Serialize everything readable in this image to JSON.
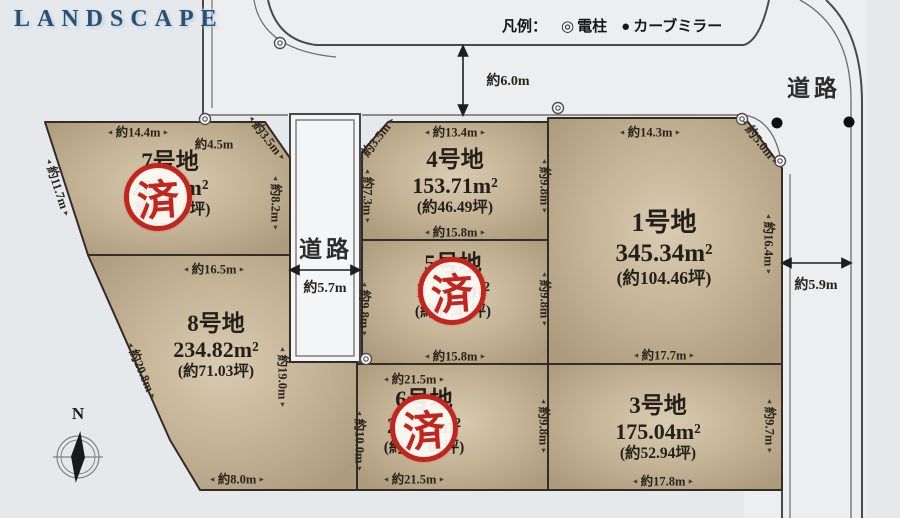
{
  "logo": "LANDSCAPE",
  "legend": {
    "label": "凡例：",
    "items": [
      {
        "symbol": "◎",
        "name": "電柱"
      },
      {
        "symbol": "●",
        "name": "カーブミラー"
      }
    ]
  },
  "roads": {
    "center_label": "道路",
    "right_label": "道路",
    "top_width": "約6.0m",
    "center_width": "約5.7m",
    "right_width": "約5.9m"
  },
  "compass": {
    "north": "N"
  },
  "stamp": {
    "text": "済"
  },
  "lots": {
    "lot1": {
      "number": "1号地",
      "area": "345.34m²",
      "tsubo": "(約104.46坪)",
      "stamped": false
    },
    "lot3": {
      "number": "3号地",
      "area": "175.04m²",
      "tsubo": "(約52.94坪)",
      "stamped": false
    },
    "lot4": {
      "number": "4号地",
      "area": "153.71m²",
      "tsubo": "(約46.49坪)",
      "stamped": false
    },
    "lot5": {
      "number": "5号地",
      "area_prefix": "1",
      "area_suffix": "m²",
      "tsubo": "(約47.41坪)",
      "stamped": true
    },
    "lot6": {
      "number": "6号地",
      "area_prefix": "2",
      "area_suffix": "m²",
      "tsubo_prefix": "(約6",
      "tsubo_suffix": "01坪)",
      "stamped": true
    },
    "lot7": {
      "number": "7号地",
      "area_prefix": "20",
      "area_suffix": "m²",
      "tsubo_prefix": "(約6",
      "tsubo_suffix": "5坪)",
      "stamped": true
    },
    "lot8": {
      "number": "8号地",
      "area": "234.82m²",
      "tsubo": "(約71.03坪)",
      "stamped": false
    }
  },
  "dimensions": {
    "lot7_top": "約14.4m",
    "lot7_top2": "約4.5m",
    "lot7_cut": "約3.5m",
    "lot7_left": "約11.7m",
    "lot7_right": "約8.2m",
    "lot4_top": "約13.4m",
    "lot4_cut": "約3.5m",
    "lot4_left": "約7.3m",
    "lot4_right": "約9.8m",
    "lot4_bottom": "約15.8m",
    "lot1_top": "約14.3m",
    "lot1_cut": "約5.0m",
    "lot1_right": "約16.4m",
    "lot1_bottom": "約17.7m",
    "lot8_top": "約16.5m",
    "lot8_left": "約20.8m",
    "lot8_right": "約19.0m",
    "lot8_bottom": "約8.0m",
    "lot5_left": "約9.8m",
    "lot5_right": "約9.8m",
    "lot5_bottom": "約15.8m",
    "lot6_top": "約21.5m",
    "lot6_bottom": "約21.5m",
    "lot6_left": "約10.0m",
    "lot6_right": "約9.8m",
    "lot3_right": "約9.7m",
    "lot3_bottom": "約17.8m"
  }
}
